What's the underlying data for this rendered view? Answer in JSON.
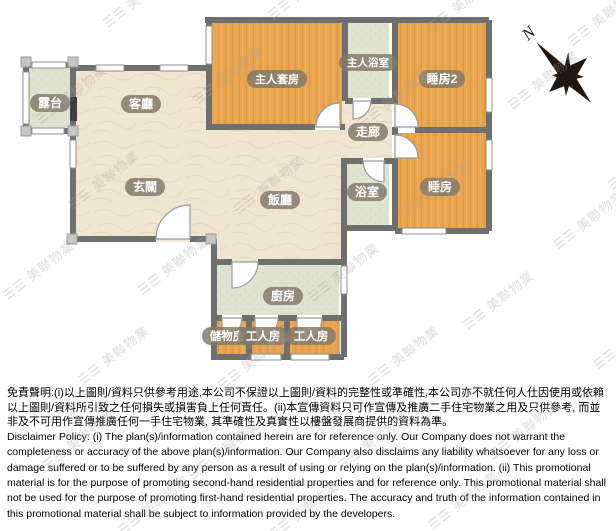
{
  "plan": {
    "compass": {
      "label": "N"
    },
    "watermark": {
      "glyph": "☰☰",
      "text": "美聯物業"
    },
    "rooms": [
      {
        "id": "terrace",
        "label": "露台"
      },
      {
        "id": "living-room",
        "label": "客廳"
      },
      {
        "id": "foyer",
        "label": "玄關"
      },
      {
        "id": "master-suite",
        "label": "主人套房"
      },
      {
        "id": "master-bathroom",
        "label": "主人浴室"
      },
      {
        "id": "bedroom-2",
        "label": "睡房2"
      },
      {
        "id": "corridor",
        "label": "走廊"
      },
      {
        "id": "bathroom",
        "label": "浴室"
      },
      {
        "id": "bedroom",
        "label": "睡房"
      },
      {
        "id": "dining-room",
        "label": "飯廳"
      },
      {
        "id": "kitchen",
        "label": "廚房"
      },
      {
        "id": "storage-room",
        "label": "儲物房"
      },
      {
        "id": "maid-room-1",
        "label": "工人房"
      },
      {
        "id": "maid-room-2",
        "label": "工人房"
      }
    ]
  },
  "colors": {
    "wall": "#6f6f6f",
    "room_orange": "#e8a44f",
    "room_beige": "#f0e5d0",
    "room_green": "#dfe2ce",
    "label_pill": "#837b6b",
    "label_text": "#ffffff"
  },
  "disclaimer": {
    "zh": "免責聲明:(i)以上圖則/資料只供參考用途,本公司不保證以上圖則/資料的完整性或準確性,本公司亦不就任何人仕因使用或依賴以上圖則/資料所引致之任何損失或損害負上任何責任。(ii)本宣傳資料只可作宣傳及推廣二手住宅物業之用及只供參考, 而並非及不可用作宣傳推廣任何一手住宅物業, 其準確性及真實性以樓盤發展商提供的資料為準。",
    "en": "Disclaimer Policy: (i) The plan(s)/information contained herein are for reference only. Our Company does not warrant the completeness or accuracy of the above plan(s)/information. Our Company also disclaims any liability whatsoever for any loss or damage suffered or to be suffered by any person as a result of using or relying on the plan(s)/information. (ii) This promotional material is for the purpose of promoting second-hand residential properties and for reference only. This promotional material shall not be used for the purpose of promoting first-hand residential properties. The accuracy and truth of the information contained in this promotional material shall be subject to information provided by the developers."
  }
}
